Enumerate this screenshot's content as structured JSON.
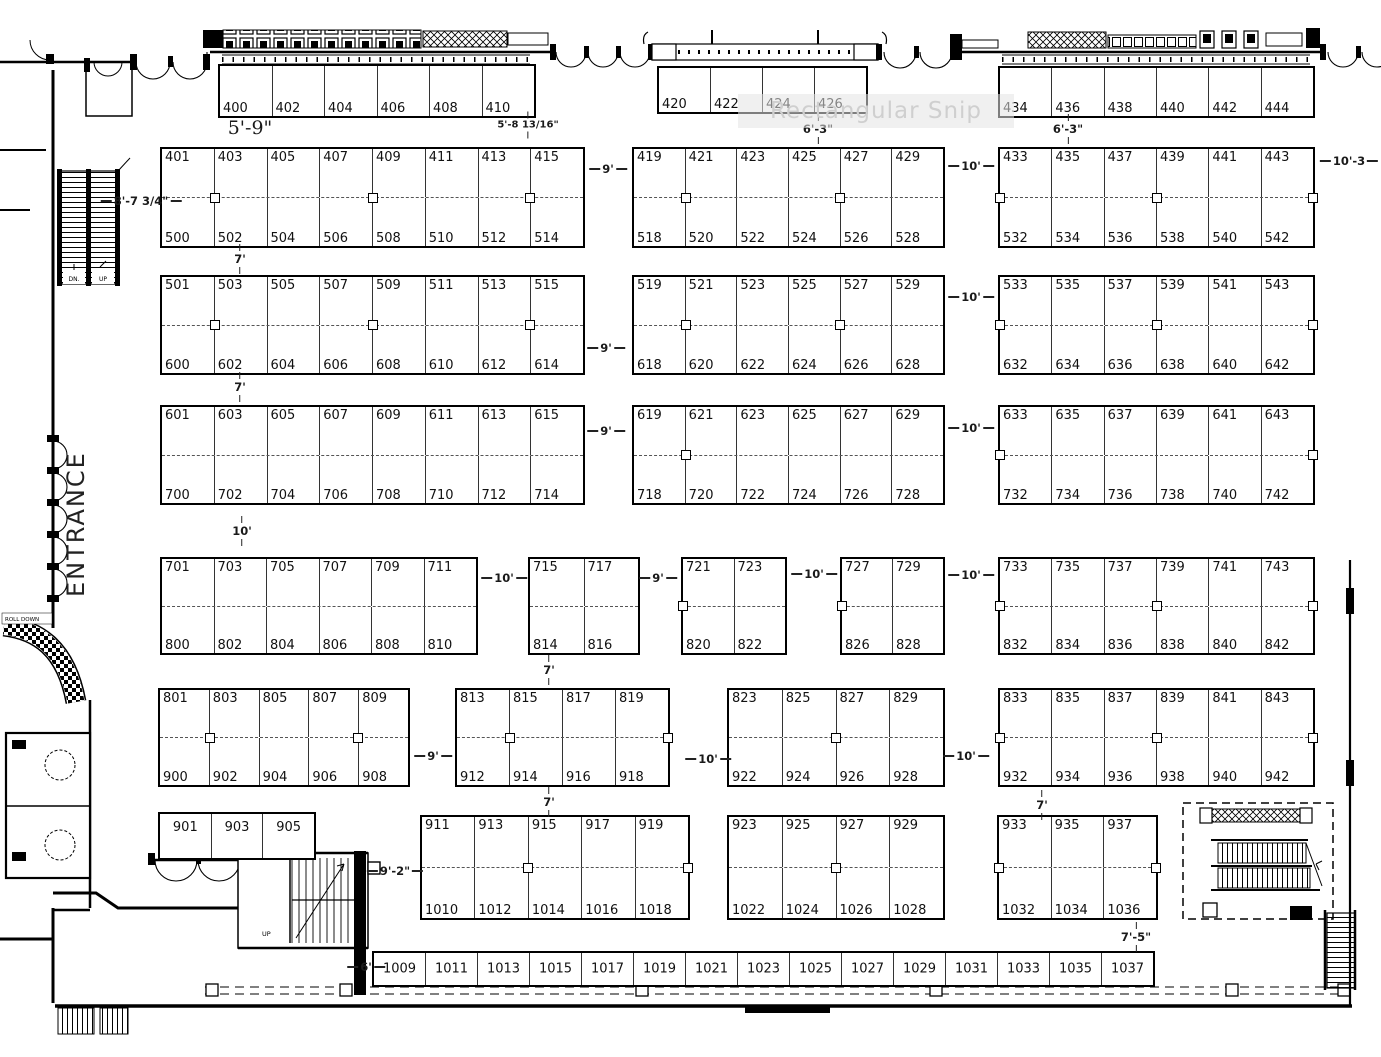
{
  "labels": {
    "entrance": "ENTRANCE",
    "watermark": "Rectangular Snip",
    "escalator_dn": "DN.",
    "escalator_up": "UP",
    "roll_down": "ROLL DOWN",
    "stair_up": "UP"
  },
  "booth_blocks": [
    {
      "x": 218,
      "y": 64,
      "w": 318,
      "h": 54,
      "cols": 6,
      "labels": [
        "400",
        "402",
        "404",
        "406",
        "408",
        "410"
      ],
      "labelPos": "bottom"
    },
    {
      "x": 657,
      "y": 66,
      "w": 211,
      "h": 48,
      "cols": 4,
      "labels": [
        "420",
        "422",
        "424",
        "426"
      ],
      "labelPos": "bottom"
    },
    {
      "x": 998,
      "y": 66,
      "w": 317,
      "h": 52,
      "cols": 6,
      "labels": [
        "434",
        "436",
        "438",
        "440",
        "442",
        "444"
      ],
      "labelPos": "bottom"
    },
    {
      "x": 160,
      "y": 147,
      "w": 425,
      "h": 101,
      "cols": 8,
      "top": [
        "401",
        "403",
        "405",
        "407",
        "409",
        "411",
        "413",
        "415"
      ],
      "bottom": [
        "500",
        "502",
        "504",
        "506",
        "508",
        "510",
        "512",
        "514"
      ],
      "markers": [
        0.125,
        0.5,
        0.875
      ]
    },
    {
      "x": 632,
      "y": 147,
      "w": 313,
      "h": 101,
      "cols": 6,
      "top": [
        "419",
        "421",
        "423",
        "425",
        "427",
        "429"
      ],
      "bottom": [
        "518",
        "520",
        "522",
        "524",
        "526",
        "528"
      ],
      "markers": [
        0.1667,
        0.6667
      ]
    },
    {
      "x": 998,
      "y": 147,
      "w": 317,
      "h": 101,
      "cols": 6,
      "top": [
        "433",
        "435",
        "437",
        "439",
        "441",
        "443"
      ],
      "bottom": [
        "532",
        "534",
        "536",
        "538",
        "540",
        "542"
      ],
      "markers": [
        0,
        0.5,
        1
      ]
    },
    {
      "x": 160,
      "y": 275,
      "w": 425,
      "h": 100,
      "cols": 8,
      "top": [
        "501",
        "503",
        "505",
        "507",
        "509",
        "511",
        "513",
        "515"
      ],
      "bottom": [
        "600",
        "602",
        "604",
        "606",
        "608",
        "610",
        "612",
        "614"
      ],
      "markers": [
        0.125,
        0.5,
        0.875
      ]
    },
    {
      "x": 632,
      "y": 275,
      "w": 313,
      "h": 100,
      "cols": 6,
      "top": [
        "519",
        "521",
        "523",
        "525",
        "527",
        "529"
      ],
      "bottom": [
        "618",
        "620",
        "622",
        "624",
        "626",
        "628"
      ],
      "markers": [
        0.1667,
        0.6667
      ]
    },
    {
      "x": 998,
      "y": 275,
      "w": 317,
      "h": 100,
      "cols": 6,
      "top": [
        "533",
        "535",
        "537",
        "539",
        "541",
        "543"
      ],
      "bottom": [
        "632",
        "634",
        "636",
        "638",
        "640",
        "642"
      ],
      "markers": [
        0,
        0.5,
        1
      ]
    },
    {
      "x": 160,
      "y": 405,
      "w": 425,
      "h": 100,
      "cols": 8,
      "top": [
        "601",
        "603",
        "605",
        "607",
        "609",
        "611",
        "613",
        "615"
      ],
      "bottom": [
        "700",
        "702",
        "704",
        "706",
        "708",
        "710",
        "712",
        "714"
      ],
      "markers": []
    },
    {
      "x": 632,
      "y": 405,
      "w": 313,
      "h": 100,
      "cols": 6,
      "top": [
        "619",
        "621",
        "623",
        "625",
        "627",
        "629"
      ],
      "bottom": [
        "718",
        "720",
        "722",
        "724",
        "726",
        "728"
      ],
      "markers": [
        0.1667
      ]
    },
    {
      "x": 998,
      "y": 405,
      "w": 317,
      "h": 100,
      "cols": 6,
      "top": [
        "633",
        "635",
        "637",
        "639",
        "641",
        "643"
      ],
      "bottom": [
        "732",
        "734",
        "736",
        "738",
        "740",
        "742"
      ],
      "markers": [
        0,
        1
      ]
    },
    {
      "x": 160,
      "y": 557,
      "w": 318,
      "h": 98,
      "cols": 6,
      "top": [
        "701",
        "703",
        "705",
        "707",
        "709",
        "711"
      ],
      "bottom": [
        "800",
        "802",
        "804",
        "806",
        "808",
        "810"
      ],
      "markers": []
    },
    {
      "x": 528,
      "y": 557,
      "w": 112,
      "h": 98,
      "cols": 2,
      "top": [
        "715",
        "717"
      ],
      "bottom": [
        "814",
        "816"
      ],
      "markers": []
    },
    {
      "x": 681,
      "y": 557,
      "w": 106,
      "h": 98,
      "cols": 2,
      "top": [
        "721",
        "723"
      ],
      "bottom": [
        "820",
        "822"
      ],
      "markers": [
        0
      ]
    },
    {
      "x": 840,
      "y": 557,
      "w": 105,
      "h": 98,
      "cols": 2,
      "top": [
        "727",
        "729"
      ],
      "bottom": [
        "826",
        "828"
      ],
      "markers": [
        0
      ]
    },
    {
      "x": 998,
      "y": 557,
      "w": 317,
      "h": 98,
      "cols": 6,
      "top": [
        "733",
        "735",
        "737",
        "739",
        "741",
        "743"
      ],
      "bottom": [
        "832",
        "834",
        "836",
        "838",
        "840",
        "842"
      ],
      "markers": [
        0,
        0.5,
        1
      ]
    },
    {
      "x": 158,
      "y": 688,
      "w": 252,
      "h": 99,
      "cols": 5,
      "top": [
        "801",
        "803",
        "805",
        "807",
        "809"
      ],
      "bottom": [
        "900",
        "902",
        "904",
        "906",
        "908"
      ],
      "markers": [
        0.2,
        0.8
      ]
    },
    {
      "x": 455,
      "y": 688,
      "w": 215,
      "h": 99,
      "cols": 4,
      "top": [
        "813",
        "815",
        "817",
        "819"
      ],
      "bottom": [
        "912",
        "914",
        "916",
        "918"
      ],
      "markers": [
        0.25,
        1
      ]
    },
    {
      "x": 727,
      "y": 688,
      "w": 218,
      "h": 99,
      "cols": 4,
      "top": [
        "823",
        "825",
        "827",
        "829"
      ],
      "bottom": [
        "922",
        "924",
        "926",
        "928"
      ],
      "markers": [
        0.5
      ]
    },
    {
      "x": 998,
      "y": 688,
      "w": 317,
      "h": 99,
      "cols": 6,
      "top": [
        "833",
        "835",
        "837",
        "839",
        "841",
        "843"
      ],
      "bottom": [
        "932",
        "934",
        "936",
        "938",
        "940",
        "942"
      ],
      "markers": [
        0,
        0.5,
        1
      ]
    },
    {
      "x": 158,
      "y": 812,
      "w": 158,
      "h": 48,
      "cols": 3,
      "labels": [
        "901",
        "903",
        "905"
      ],
      "labelPos": "top"
    },
    {
      "x": 420,
      "y": 815,
      "w": 270,
      "h": 105,
      "cols": 5,
      "top": [
        "911",
        "913",
        "915",
        "917",
        "919"
      ],
      "bottom": [
        "1010",
        "1012",
        "1014",
        "1016",
        "1018"
      ],
      "markers": [
        0.4,
        1
      ]
    },
    {
      "x": 727,
      "y": 815,
      "w": 218,
      "h": 105,
      "cols": 4,
      "top": [
        "923",
        "925",
        "927",
        "929"
      ],
      "bottom": [
        "1022",
        "1024",
        "1026",
        "1028"
      ],
      "markers": [
        0.5
      ]
    },
    {
      "x": 997,
      "y": 815,
      "w": 161,
      "h": 105,
      "cols": 3,
      "top": [
        "933",
        "935",
        "937"
      ],
      "bottom": [
        "1032",
        "1034",
        "1036"
      ],
      "markers": [
        0,
        1
      ]
    },
    {
      "x": 372,
      "y": 951,
      "w": 783,
      "h": 36,
      "cols": 15,
      "labels": [
        "1009",
        "1011",
        "1013",
        "1015",
        "1017",
        "1019",
        "1021",
        "1023",
        "1025",
        "1027",
        "1029",
        "1031",
        "1033",
        "1035",
        "1037"
      ],
      "labelPos": "center"
    }
  ],
  "dimensions": [
    {
      "t": "5'-9\"",
      "x": 250,
      "y": 128,
      "o": "n",
      "lg": true
    },
    {
      "t": "5'-8 13/16\"",
      "x": 528,
      "y": 125,
      "o": "v",
      "sm": true
    },
    {
      "t": "6'-3\"",
      "x": 818,
      "y": 129,
      "o": "v"
    },
    {
      "t": "6'-3\"",
      "x": 1068,
      "y": 129,
      "o": "v"
    },
    {
      "t": "8'-7 3/4\"",
      "x": 141,
      "y": 201,
      "o": "h"
    },
    {
      "t": "9'",
      "x": 608,
      "y": 169,
      "o": "h"
    },
    {
      "t": "10'",
      "x": 971,
      "y": 166,
      "o": "h"
    },
    {
      "t": "10'-3",
      "x": 1349,
      "y": 161,
      "o": "h"
    },
    {
      "t": "7'",
      "x": 240,
      "y": 259,
      "o": "v"
    },
    {
      "t": "10'",
      "x": 971,
      "y": 297,
      "o": "h"
    },
    {
      "t": "9'",
      "x": 606,
      "y": 348,
      "o": "h"
    },
    {
      "t": "7'",
      "x": 240,
      "y": 387,
      "o": "v"
    },
    {
      "t": "9'",
      "x": 606,
      "y": 431,
      "o": "h"
    },
    {
      "t": "10'",
      "x": 971,
      "y": 428,
      "o": "h"
    },
    {
      "t": "10'",
      "x": 242,
      "y": 531,
      "o": "v"
    },
    {
      "t": "10'",
      "x": 504,
      "y": 578,
      "o": "h"
    },
    {
      "t": "9'",
      "x": 658,
      "y": 578,
      "o": "h"
    },
    {
      "t": "10'",
      "x": 814,
      "y": 574,
      "o": "h"
    },
    {
      "t": "10'",
      "x": 971,
      "y": 575,
      "o": "h"
    },
    {
      "t": "7'",
      "x": 549,
      "y": 670,
      "o": "v"
    },
    {
      "t": "9'",
      "x": 433,
      "y": 756,
      "o": "h"
    },
    {
      "t": "10'",
      "x": 708,
      "y": 759,
      "o": "h"
    },
    {
      "t": "10'",
      "x": 966,
      "y": 756,
      "o": "h"
    },
    {
      "t": "7'",
      "x": 549,
      "y": 802,
      "o": "v"
    },
    {
      "t": "7'",
      "x": 1042,
      "y": 805,
      "o": "v"
    },
    {
      "t": "9'-2\"",
      "x": 395,
      "y": 871,
      "o": "h"
    },
    {
      "t": "7'-5\"",
      "x": 1136,
      "y": 937,
      "o": "v"
    },
    {
      "t": "6'",
      "x": 366,
      "y": 967,
      "o": "h"
    }
  ]
}
